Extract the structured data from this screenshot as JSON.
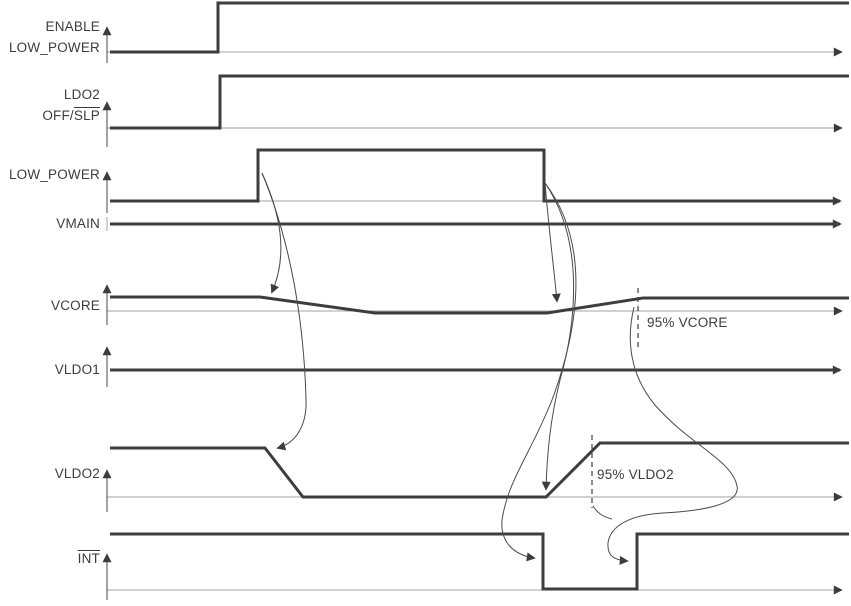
{
  "colors": {
    "line": "#3d3d3d",
    "light_line": "#a3a3a3",
    "connector": "#4a4a4a",
    "text": "#3d3d3d",
    "background": "#ffffff"
  },
  "labels": {
    "enable": {
      "line1": "ENABLE",
      "line2": "LOW_POWER"
    },
    "ldo2": {
      "line1": "LDO2",
      "line2_plain": "OFF/",
      "line2_overline": "SLP"
    },
    "low_power": {
      "text": "LOW_POWER"
    },
    "vmain": {
      "text": "VMAIN"
    },
    "vcore": {
      "text": "VCORE"
    },
    "vldo1": {
      "text": "VLDO1"
    },
    "vldo2": {
      "text": "VLDO2"
    },
    "int": {
      "text_overline": "INT"
    }
  },
  "annotations": {
    "vcore_95": "95% VCORE",
    "vldo2_95": "95% VLDO2"
  },
  "chart_data": {
    "type": "timing",
    "title": "",
    "time_axis": {
      "unit": "relative time, unlabeled arrows to the right",
      "plot_px_range": [
        107,
        845
      ]
    },
    "signals": [
      {
        "name": "ENABLE LOW_POWER",
        "kind": "digital",
        "initial": "low",
        "final": "high",
        "edges": [
          {
            "t_px": 218,
            "edge": "rise"
          }
        ]
      },
      {
        "name": "LDO2 OFF/SLP (SLP overlined)",
        "kind": "digital",
        "initial": "low",
        "final": "high",
        "edges": [
          {
            "t_px": 220,
            "edge": "rise"
          }
        ]
      },
      {
        "name": "LOW_POWER",
        "kind": "digital",
        "initial": "low",
        "final": "low",
        "edges": [
          {
            "t_px": 258,
            "edge": "rise"
          },
          {
            "t_px": 544,
            "edge": "fall"
          }
        ]
      },
      {
        "name": "VMAIN",
        "kind": "analog",
        "behavior": "constant level for entire window"
      },
      {
        "name": "VCORE",
        "kind": "analog",
        "behavior": "nominal level; droops slightly (ramp 260-375px) while LOW_POWER is high; recovers (ramp 547-643px); dashed 95% VCORE marker at 638px"
      },
      {
        "name": "VLDO1",
        "kind": "analog",
        "behavior": "constant level for entire window"
      },
      {
        "name": "VLDO2",
        "kind": "analog",
        "behavior": "on; ramps down 265-303px after LOW_POWER rises; off while LOW_POWER high; ramps up 546-600px after LOW_POWER falls; dashed 95% VLDO2 marker at 592px"
      },
      {
        "name": "INT (overlined, active low)",
        "kind": "digital",
        "initial": "high",
        "final": "high",
        "edges": [
          {
            "t_px": 543,
            "edge": "fall"
          },
          {
            "t_px": 637,
            "edge": "rise"
          }
        ]
      }
    ],
    "dependencies": [
      {
        "from": "LOW_POWER rising edge",
        "to": "VCORE droop start"
      },
      {
        "from": "LOW_POWER rising edge",
        "to": "VLDO2 ramp-down start"
      },
      {
        "from": "LOW_POWER falling edge",
        "to": "VCORE recovery start"
      },
      {
        "from": "LOW_POWER falling edge",
        "to": "VLDO2 ramp-up start"
      },
      {
        "from": "LOW_POWER falling edge",
        "to": "INT falling edge"
      },
      {
        "from": "95% VCORE point",
        "to": "INT rising edge"
      },
      {
        "from": "95% VLDO2 point",
        "to": "INT rising edge"
      }
    ],
    "annotations": [
      "95% VCORE",
      "95% VLDO2"
    ]
  },
  "render": {
    "elements": [
      {
        "t": "line",
        "name": "enable-baseline",
        "cls": "light",
        "arrow": 1,
        "attrs": {
          "x1": 107,
          "y1": 52,
          "x2": 841,
          "y2": 52
        }
      },
      {
        "t": "line",
        "name": "ldo2-baseline",
        "cls": "light",
        "arrow": 1,
        "attrs": {
          "x1": 107,
          "y1": 128,
          "x2": 841,
          "y2": 128
        }
      },
      {
        "t": "line",
        "name": "low-power-baseline",
        "cls": "light",
        "arrow": 0,
        "attrs": {
          "x1": 110,
          "y1": 201,
          "x2": 544,
          "y2": 201
        }
      },
      {
        "t": "line",
        "name": "vcore-refline",
        "cls": "light",
        "arrow": 1,
        "attrs": {
          "x1": 107,
          "y1": 311,
          "x2": 841,
          "y2": 311
        }
      },
      {
        "t": "line",
        "name": "vldo2-refline",
        "cls": "light",
        "arrow": 1,
        "attrs": {
          "x1": 107,
          "y1": 497,
          "x2": 841,
          "y2": 497
        }
      },
      {
        "t": "line",
        "name": "int-refline",
        "cls": "light",
        "arrow": 1,
        "attrs": {
          "x1": 107,
          "y1": 590,
          "x2": 841,
          "y2": 590
        }
      },
      {
        "t": "line",
        "name": "enable-axis",
        "cls": "thin",
        "arrow": 1,
        "attrs": {
          "x1": 107,
          "y1": 63,
          "x2": 107,
          "y2": 28
        }
      },
      {
        "t": "line",
        "name": "ldo2-axis",
        "cls": "thin",
        "arrow": 1,
        "attrs": {
          "x1": 107,
          "y1": 147,
          "x2": 107,
          "y2": 103
        }
      },
      {
        "t": "line",
        "name": "low-power-axis",
        "cls": "thin",
        "arrow": 1,
        "attrs": {
          "x1": 107,
          "y1": 213,
          "x2": 107,
          "y2": 173
        }
      },
      {
        "t": "line",
        "name": "vmain-tick",
        "cls": "light",
        "arrow": 0,
        "attrs": {
          "x1": 107,
          "y1": 217,
          "x2": 107,
          "y2": 231
        }
      },
      {
        "t": "line",
        "name": "vcore-axis",
        "cls": "thin",
        "arrow": 1,
        "attrs": {
          "x1": 107,
          "y1": 325,
          "x2": 107,
          "y2": 286
        }
      },
      {
        "t": "line",
        "name": "vldo1-axis",
        "cls": "thin",
        "arrow": 1,
        "attrs": {
          "x1": 107,
          "y1": 387,
          "x2": 107,
          "y2": 348
        }
      },
      {
        "t": "line",
        "name": "vldo2-axis",
        "cls": "thin",
        "arrow": 1,
        "attrs": {
          "x1": 107,
          "y1": 512,
          "x2": 107,
          "y2": 471
        }
      },
      {
        "t": "line",
        "name": "int-axis",
        "cls": "thin",
        "arrow": 1,
        "attrs": {
          "x1": 107,
          "y1": 600,
          "x2": 107,
          "y2": 555
        }
      },
      {
        "t": "path",
        "name": "enable-wave",
        "cls": "wave",
        "arrow": 0,
        "attrs": {
          "d": "M 110 52 H 218 V 3 H 849"
        }
      },
      {
        "t": "path",
        "name": "ldo2-wave",
        "cls": "wave",
        "arrow": 0,
        "attrs": {
          "d": "M 110 128 H 220 V 76 H 849"
        }
      },
      {
        "t": "path",
        "name": "low-power-wave",
        "cls": "wave",
        "arrow": 1,
        "attrs": {
          "d": "M 110 201 H 258 V 150 H 544 V 201 H 840"
        }
      },
      {
        "t": "path",
        "name": "vmain-wave",
        "cls": "wave",
        "arrow": 1,
        "attrs": {
          "d": "M 110 224 H 840"
        }
      },
      {
        "t": "path",
        "name": "vcore-wave",
        "cls": "wave",
        "arrow": 0,
        "attrs": {
          "d": "M 110 297 H 260 L 375 313 H 547 L 643 298 H 849"
        }
      },
      {
        "t": "path",
        "name": "vldo1-wave",
        "cls": "wave",
        "arrow": 1,
        "attrs": {
          "d": "M 110 370 H 840"
        }
      },
      {
        "t": "path",
        "name": "vldo2-wave",
        "cls": "wave",
        "arrow": 0,
        "attrs": {
          "d": "M 110 448 H 265 L 303 497 H 546 L 600 443 H 849"
        }
      },
      {
        "t": "path",
        "name": "int-wave",
        "cls": "wave",
        "arrow": 0,
        "attrs": {
          "d": "M 110 534 H 543 V 589 H 637 V 534 H 849"
        }
      },
      {
        "t": "line",
        "name": "vcore-95-dashline",
        "cls": "dash",
        "arrow": 0,
        "attrs": {
          "x1": 638,
          "y1": 288,
          "x2": 638,
          "y2": 347
        }
      },
      {
        "t": "line",
        "name": "vldo2-95-dashline",
        "cls": "dash",
        "arrow": 0,
        "attrs": {
          "x1": 592,
          "y1": 435,
          "x2": 592,
          "y2": 508
        }
      },
      {
        "t": "path",
        "name": "conn-lp-rise-to-vcore",
        "cls": "conn",
        "arrow": 1,
        "attrs": {
          "d": "M 262 173 C 281 215 288 255 272 292"
        }
      },
      {
        "t": "path",
        "name": "conn-lp-rise-to-vldo2",
        "cls": "conn",
        "arrow": 1,
        "attrs": {
          "d": "M 262 173 C 290 240 304 320 306 400 C 307 425 296 443 278 448"
        }
      },
      {
        "t": "path",
        "name": "conn-lp-fall-to-vcore",
        "cls": "conn",
        "arrow": 1,
        "attrs": {
          "d": "M 545 183 C 549 230 554 270 557 301"
        }
      },
      {
        "t": "path",
        "name": "conn-lp-fall-to-vldo2",
        "cls": "conn",
        "arrow": 1,
        "attrs": {
          "d": "M 545 183 C 584 240 577 320 560 380 C 550 420 547 455 546 489"
        }
      },
      {
        "t": "path",
        "name": "conn-lp-fall-to-int",
        "cls": "conn",
        "arrow": 1,
        "attrs": {
          "d": "M 545 183 C 592 245 578 330 552 400 C 530 455 508 480 502 520 C 500 543 515 555 534 558"
        }
      },
      {
        "t": "path",
        "name": "conn-vcore95-to-int",
        "cls": "conn",
        "arrow": 1,
        "attrs": {
          "d": "M 634 307 C 626 340 630 375 655 405 C 690 445 732 460 737 486 C 741 505 700 511 663 513 C 628 515 610 527 608 543 C 607 556 614 560 627 561"
        }
      },
      {
        "t": "path",
        "name": "conn-vldo295-join",
        "cls": "conn",
        "arrow": 0,
        "attrs": {
          "d": "M 593 506 C 598 514 604 517 612 519"
        }
      }
    ]
  }
}
